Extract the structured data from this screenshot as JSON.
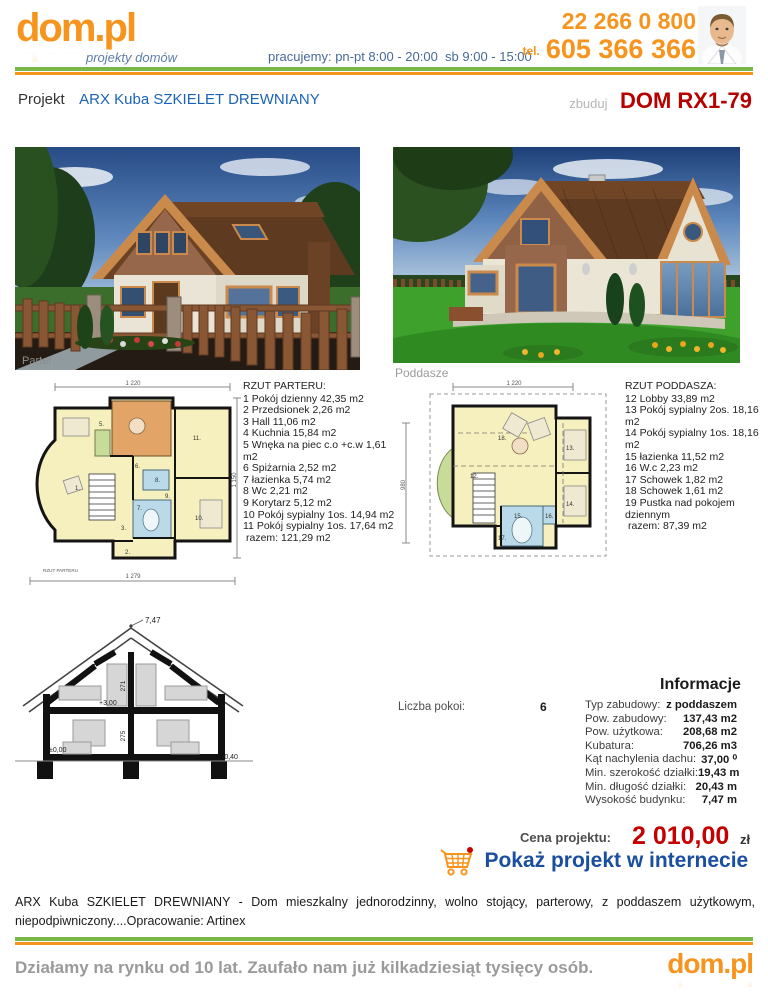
{
  "header": {
    "logo_text": "dom.pl",
    "logo_tagline": "projekty domów",
    "hours": "pracujemy: pn-pt 8:00 - 20:00  sb 9:00 - 15:00",
    "tel_label": "tel.",
    "phone1": "22 266 0 800",
    "phone2": "605 366 366"
  },
  "title_bar": {
    "prefix": "Projekt",
    "project_name": "ARX Kuba SZKIELET DREWNIANY",
    "zbuduj": "zbuduj",
    "code": "DOM RX1-79"
  },
  "images": {
    "parter_label": "Parter",
    "poddasze_label": "Poddasze"
  },
  "parter_plan": {
    "heading": "RZUT PARTERU:",
    "items": [
      "1 Pokój dzienny 42,35 m2",
      "2 Przedsionek 2,26 m2",
      "3 Hall 11,06 m2",
      "4 Kuchnia 15,84 m2",
      "5 Wnęka na piec c.o +c.w 1,61 m2",
      "6 Spiżarnia 2,52 m2",
      "7 łazienka 5,74 m2",
      "8 Wc 2,21 m2",
      "9 Korytarz 5,12 m2",
      "10 Pokój sypialny 1os. 14,94 m2",
      "11 Pokój sypialny 1os. 17,64 m2",
      "razem: 121,29 m2"
    ],
    "numbers": [
      "1.",
      "2.",
      "3.",
      "5.",
      "6.",
      "7.",
      "8.",
      "9.",
      "10.",
      "11."
    ],
    "dim_top": "1 220",
    "dim_right": "1 150",
    "dim_bottom": "1 279",
    "plan_label": "RZUT PARTERU"
  },
  "poddasze_plan": {
    "heading": "RZUT PODDASZA:",
    "items": [
      "12 Lobby 33,89 m2",
      "13 Pokój sypialny 2os. 18,16 m2",
      "14 Pokój sypialny 1os. 18,16 m2",
      "15 łazienka 11,52 m2",
      "16 W.c 2,23 m2",
      "17 Schowek 1,82 m2",
      "18 Schowek 1,61 m2",
      "19 Pustka nad pokojem dziennym",
      "razem: 87,39 m2"
    ],
    "numbers": [
      "12.",
      "13.",
      "14.",
      "15.",
      "16.",
      "17.",
      "18."
    ],
    "dim_top": "1 220",
    "dim_left": "980"
  },
  "section_drawing": {
    "peak": "7,47",
    "level_mid": "+3,00",
    "level_zero": "±0,00",
    "level_minus": "-0,40",
    "dim_upper": "271",
    "dim_lower": "275"
  },
  "info": {
    "heading": "Informacje",
    "rooms_label": "Liczba pokoi:",
    "rooms_value": "6",
    "rows": [
      {
        "label": "Typ zabudowy:",
        "value": "z poddaszem"
      },
      {
        "label": "Pow. zabudowy:",
        "value": "137,43 m2"
      },
      {
        "label": "Pow. użytkowa:",
        "value": "208,68 m2"
      },
      {
        "label": "Kubatura:",
        "value": "706,26 m3"
      },
      {
        "label": "Kąt nachylenia dachu:",
        "value": "37,00 ⁰"
      },
      {
        "label": "Min. szerokość działki:",
        "value": "19,43 m"
      },
      {
        "label": "Min. długość działki:",
        "value": "20,43 m"
      },
      {
        "label": "Wysokość budynku:",
        "value": "7,47 m"
      }
    ]
  },
  "price": {
    "label": "Cena projektu:",
    "amount": "2 010,00",
    "currency": "zł",
    "cta": "Pokaż projekt w internecie"
  },
  "description": "ARX Kuba SZKIELET DREWNIANY - Dom mieszkalny jednorodzinny, wolno stojący, parterowy, z poddaszem użytkowym, niepodpiwniczony....Opracowanie: Artinex",
  "footer": {
    "tagline": "Działamy na rynku od 10 lat. Zaufało nam już kilkadziesiąt tysięcy osób.",
    "logo_text": "dom.pl"
  },
  "colors": {
    "orange": "#f7941d",
    "green": "#7ab648",
    "blue_link": "#1a64b8",
    "red": "#c40000",
    "cta_blue": "#1a4fa0"
  }
}
